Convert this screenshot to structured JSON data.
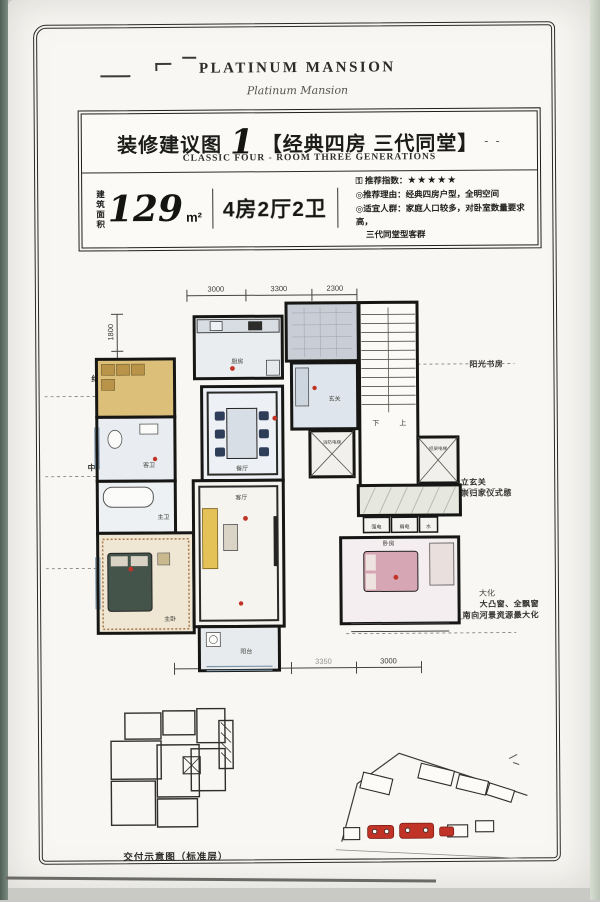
{
  "colors": {
    "accent_red": "#c03326",
    "wall": "#161614",
    "paper": "#f8f7f3",
    "tan": "#dcc07a",
    "navy": "#2e3d58"
  },
  "page": {
    "brand": "PLATINUM MANSION",
    "brand_signature": "Platinum Mansion",
    "title": {
      "prefix": "装修建议图",
      "number": "1",
      "bracket": "【经典四房 三代同堂】",
      "dashes": "- -",
      "subtitle": "CLASSIC FOUR - ROOM THREE GENERATIONS"
    },
    "info": {
      "area_label_1": "建筑",
      "area_label_2": "面积",
      "area_value": "129",
      "area_unit": "m²",
      "layout": "4房2厅2卫",
      "rating_label": "推荐指数：",
      "stars": "★★★★★",
      "reason": "◎推荐理由：经典四房户型，全明空间",
      "audience_1": "◎适宜人群：家庭人口较多，对卧室数量要求高，",
      "audience_2": "三代同堂型客群"
    },
    "plan": {
      "dims_top": [
        "3000",
        "3300",
        "2300"
      ],
      "dims_left": [
        "1800",
        "3140",
        "2100",
        "2000",
        "450",
        "4150"
      ],
      "dims_bottom": [
        "3650",
        "3350",
        "3000"
      ],
      "callouts_left": [
        {
          "l1": "约3.3米大开间餐厅",
          "l2": "尊享家族美食盛宴"
        },
        {
          "l1": "全明通透格局",
          "l2": "中轴线南北一气贯通"
        },
        {
          "l1": "私密卧房",
          "l2": "私密卫浴"
        }
      ],
      "callouts_right": [
        {
          "l1": "阳光书房",
          "l2": ""
        },
        {
          "l1": "独立玄关",
          "l2": "尊崇归家仪式感"
        },
        {
          "l1": "大凸窗、全飘窗",
          "l2": "视野开阔，南向河景资源最大化"
        }
      ],
      "stray_text": "大化",
      "rooms": {
        "kitchen": "厨房",
        "dining": "餐厅",
        "living": "客厅",
        "balcony": "阳台",
        "foyer": "玄关",
        "bath_guest": "客卫",
        "bath_master": "主卫",
        "bedroom_master": "主卧",
        "bedroom_2": "卧房",
        "stairs_down": "下",
        "stairs_up": "上",
        "elev_1": "消防电梯",
        "elev_2": "担架电梯",
        "shaft_strong": "强电",
        "shaft_weak": "弱电",
        "shaft_water": "水"
      }
    },
    "footer": {
      "key_plan_caption": "交付示意图（标准层）"
    }
  }
}
